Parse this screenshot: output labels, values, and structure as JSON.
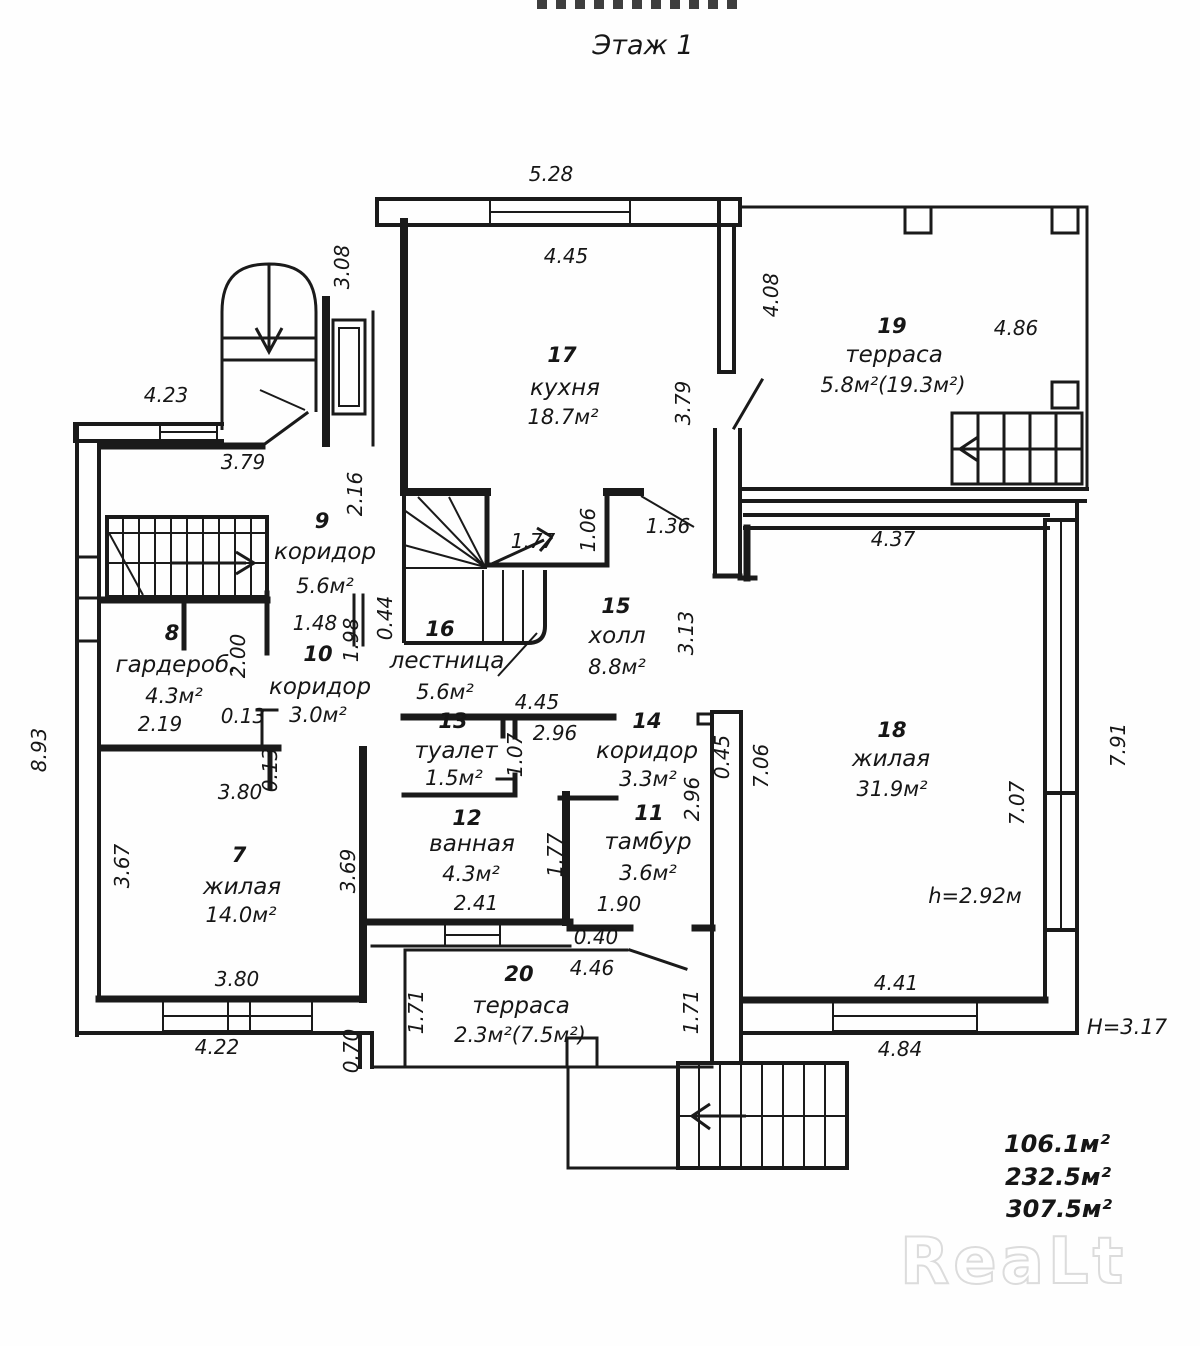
{
  "title": "Этаж 1",
  "watermark": "ReaLt",
  "rooms": {
    "r7": {
      "num": "7",
      "name": "жилая",
      "area": "14.0м²"
    },
    "r8": {
      "num": "8",
      "name": "гардероб.",
      "area": "4.3м²"
    },
    "r9": {
      "num": "9",
      "name": "коридор",
      "area": "5.6м²"
    },
    "r10": {
      "num": "10",
      "name": "коридор",
      "area": "3.0м²"
    },
    "r11": {
      "num": "11",
      "name": "тамбур",
      "area": "3.6м²"
    },
    "r12": {
      "num": "12",
      "name": "ванная",
      "area": "4.3м²"
    },
    "r13": {
      "num": "13",
      "name": "туалет",
      "area": "1.5м²"
    },
    "r14": {
      "num": "14",
      "name": "коридор",
      "area": "3.3м²"
    },
    "r15": {
      "num": "15",
      "name": "холл",
      "area": "8.8м²"
    },
    "r16": {
      "num": "16",
      "name": "лестница",
      "area": "5.6м²"
    },
    "r17": {
      "num": "17",
      "name": "кухня",
      "area": "18.7м²"
    },
    "r18": {
      "num": "18",
      "name": "жилая",
      "area": "31.9м²"
    },
    "r19": {
      "num": "19",
      "name": "терраса",
      "area": "5.8м²(19.3м²)"
    },
    "r20": {
      "num": "20",
      "name": "терраса",
      "area": "2.3м²(7.5м²)"
    }
  },
  "dims": {
    "d528": "5.28",
    "d445k": "4.45",
    "d308": "3.08",
    "d423": "4.23",
    "d379a": "3.79",
    "d408": "4.08",
    "d486": "4.86",
    "d379b": "3.79",
    "d216": "2.16",
    "d177a": "1.77",
    "d106": "1.06",
    "d136": "1.36",
    "d437": "4.37",
    "d044": "0.44",
    "d148": "1.48",
    "d198": "1.98",
    "d200": "2.00",
    "d313": "3.13",
    "d219": "2.19",
    "d013a": "0.13",
    "d013b": "0.13",
    "d893": "8.93",
    "d380a": "3.80",
    "d445h": "4.45",
    "d296a": "2.96",
    "d107": "1.07",
    "d045": "0.45",
    "d296b": "2.96",
    "d706": "7.06",
    "d791": "7.91",
    "d707": "7.07",
    "d367": "3.67",
    "d369": "3.69",
    "d177b": "1.77",
    "d241": "2.41",
    "d190": "1.90",
    "d040": "0.40",
    "d380b": "3.80",
    "d446": "4.46",
    "d441": "4.41",
    "d422": "4.22",
    "d070": "0.70",
    "d171a": "1.71",
    "d171b": "1.71",
    "d484": "4.84"
  },
  "notes": {
    "ceiling": "h=2.92м",
    "building_height": "H=3.17"
  },
  "totals": {
    "a1": "106.1м²",
    "a2": "232.5м²",
    "a3": "307.5м²"
  }
}
